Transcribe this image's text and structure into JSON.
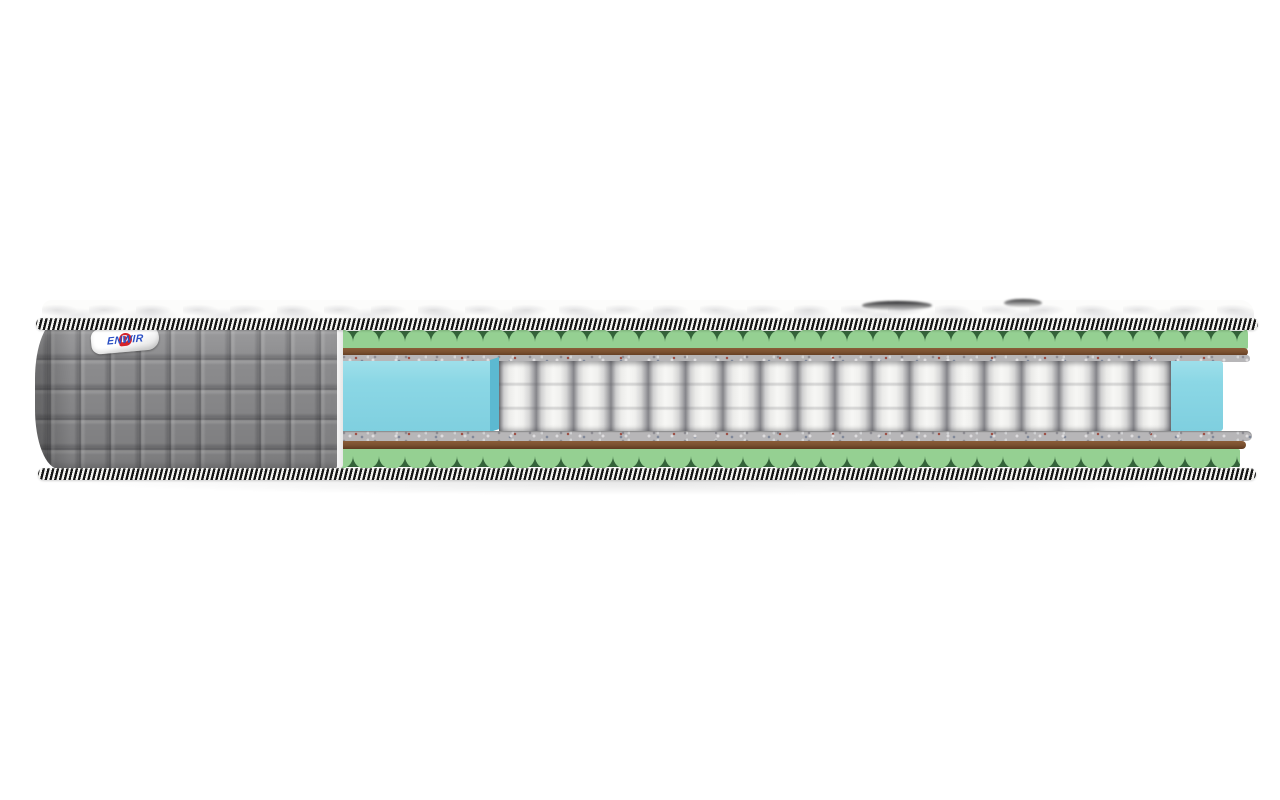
{
  "scene": {
    "description": "Cutaway product photo of a pocket-spring mattress on a white background",
    "background_color": "#ffffff"
  },
  "brand": {
    "name": "Denwir",
    "logo_initial": "D",
    "logo_text": "ENWIR"
  },
  "mattress": {
    "cover": {
      "name": "quilted-side-cover",
      "color": "#8e8e90",
      "quilt_cell_px": 30,
      "piping_style": "black-white diagonal stripes"
    },
    "top_panel": {
      "name": "quilted-top-panel",
      "color": "#fcfcfb",
      "dark_marks_count": 2
    },
    "layers": [
      {
        "name": "wave-foam-top",
        "color": "#95d092",
        "shadow_color": "#34633a"
      },
      {
        "name": "coir-layer-top",
        "color": "#7a5130"
      },
      {
        "name": "felt-layer-top",
        "color": "#b7b6b8"
      },
      {
        "name": "pocket-spring-core",
        "color": "#f3f3f1",
        "spring_count": 18
      },
      {
        "name": "edge-foam-left",
        "color": "#8bd7e5",
        "side_color": "#5cb9d1"
      },
      {
        "name": "edge-foam-right",
        "color": "#8bd7e5"
      },
      {
        "name": "felt-layer-bottom",
        "color": "#b7b6b8"
      },
      {
        "name": "coir-layer-bottom",
        "color": "#7a5130"
      },
      {
        "name": "wave-foam-bottom",
        "color": "#95d092",
        "shadow_color": "#34633a"
      }
    ]
  },
  "palette": {
    "background": "#ffffff",
    "cover_gray": "#8e8e90",
    "foam_green": "#95d092",
    "foam_green_shadow": "#34633a",
    "coir_brown": "#7a5130",
    "coir_brown_light": "#8a5c38",
    "coir_brown_dark": "#5e3a20",
    "felt_gray": "#b7b6b8",
    "spring_white": "#f3f3f1",
    "edge_foam_cyan": "#8bd7e5",
    "edge_foam_cyan_side": "#5cb9d1",
    "piping_black": "#141414",
    "piping_white": "#f4f4f1",
    "label_red": "#d6232a",
    "label_blue": "#2b50c4"
  }
}
